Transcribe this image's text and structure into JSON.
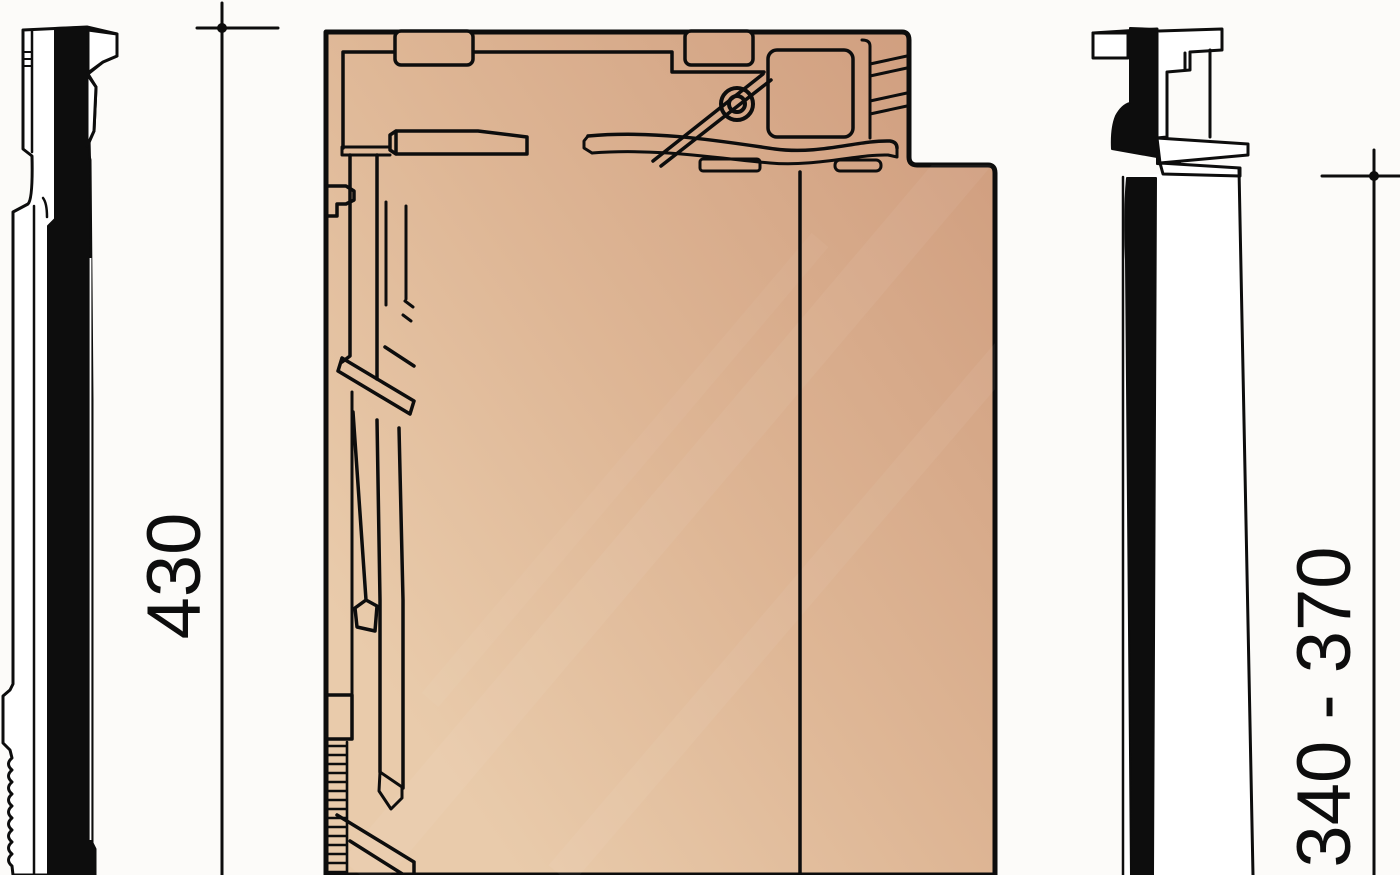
{
  "page": {
    "width": 1400,
    "height": 875,
    "background": "#fcfbf9"
  },
  "drawing": {
    "type": "technical-drawing",
    "subject": "clay roof tile - underside plan view with left and right side profiles",
    "colors": {
      "line": "#0d0d0d",
      "white": "#ffffff",
      "clay_light": "#e9cbab",
      "clay_mid": "#deb695",
      "clay_dark": "#d09e7f"
    },
    "dimensions": {
      "overall_length": {
        "label": "430",
        "orientation": "vertical",
        "position": "left-of-plan"
      },
      "batten_gauge": {
        "label": "340 - 370",
        "orientation": "vertical",
        "position": "right-of-plan"
      }
    }
  }
}
